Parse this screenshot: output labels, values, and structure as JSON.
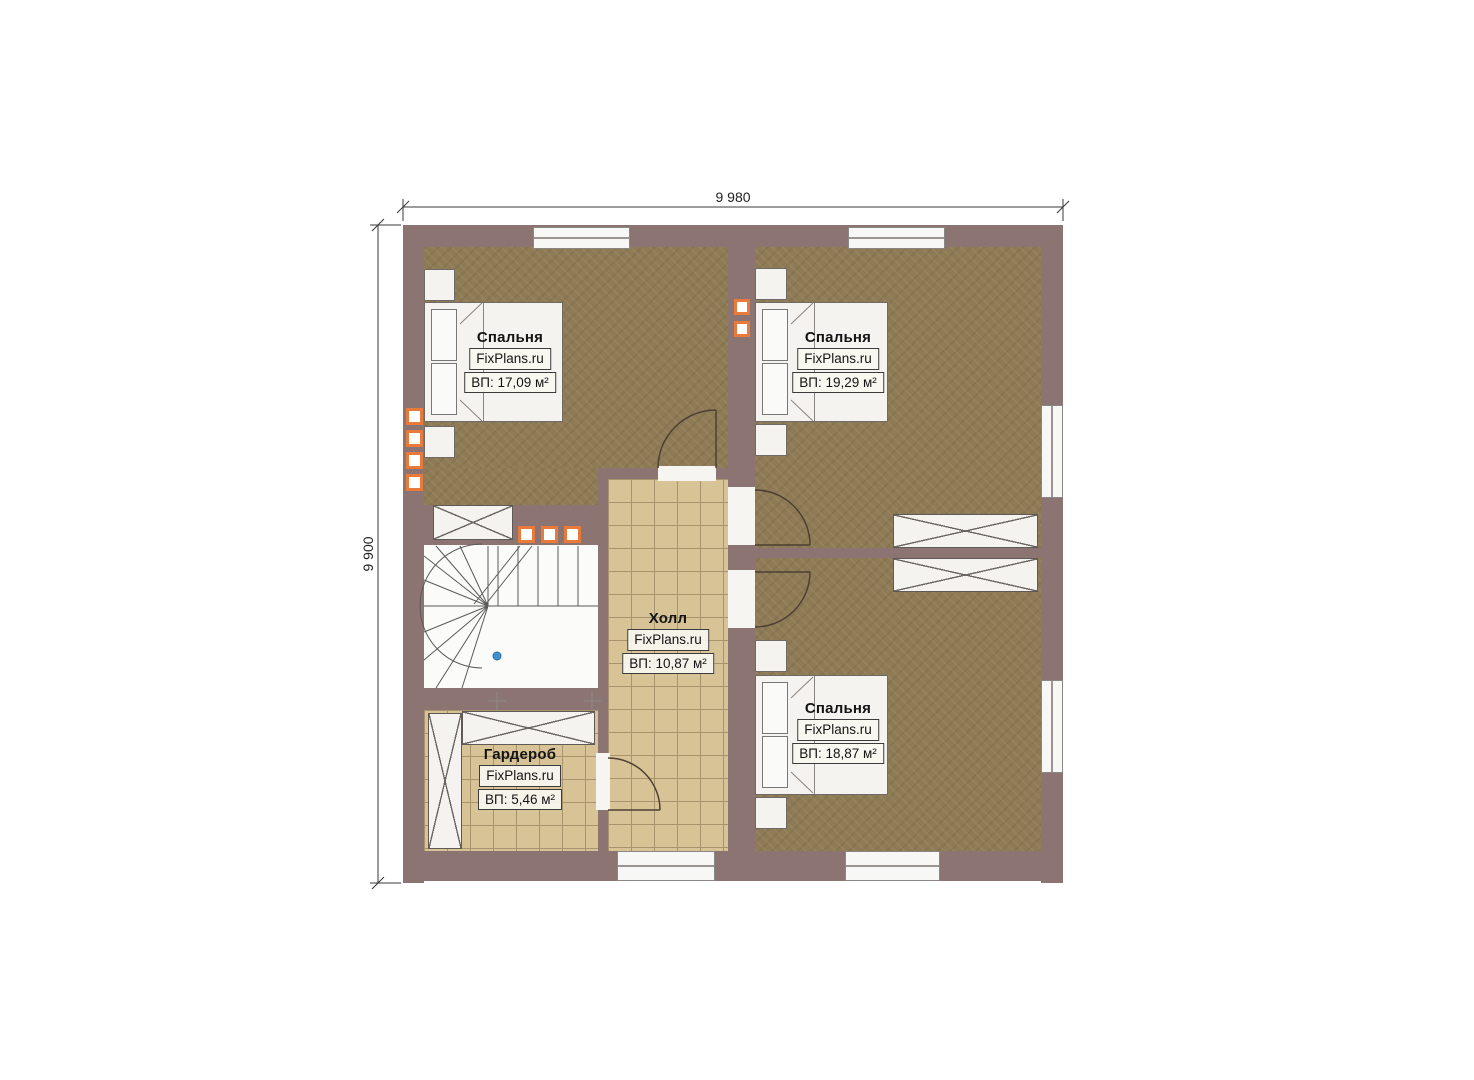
{
  "plan": {
    "site": "FixPlans.ru",
    "floor_type": "second-floor-plan"
  },
  "dimensions": {
    "top_label": "9 980",
    "left_label": "9 900"
  },
  "rooms": [
    {
      "id": "bedroom-top-left",
      "name": "Спальня",
      "brand": "FixPlans.ru",
      "area": "ВП: 17,09 м²"
    },
    {
      "id": "bedroom-top-right",
      "name": "Спальня",
      "brand": "FixPlans.ru",
      "area": "ВП: 19,29 м²"
    },
    {
      "id": "bedroom-bottom-right",
      "name": "Спальня",
      "brand": "FixPlans.ru",
      "area": "ВП: 18,87 м²"
    },
    {
      "id": "hall",
      "name": "Холл",
      "brand": "FixPlans.ru",
      "area": "ВП: 10,87 м²"
    },
    {
      "id": "wardrobe-room",
      "name": "Гардероб",
      "brand": "FixPlans.ru",
      "area": "ВП: 5,46 м²"
    }
  ],
  "colors": {
    "wall": "#8b7472",
    "wood_floor": "#8e7b55",
    "tile_floor": "#d8c396",
    "tile_grid": "#a8946c",
    "vent_accent": "#e87a3c",
    "door_line": "#4d3f33",
    "stair_marker": "#3f8fd2"
  }
}
